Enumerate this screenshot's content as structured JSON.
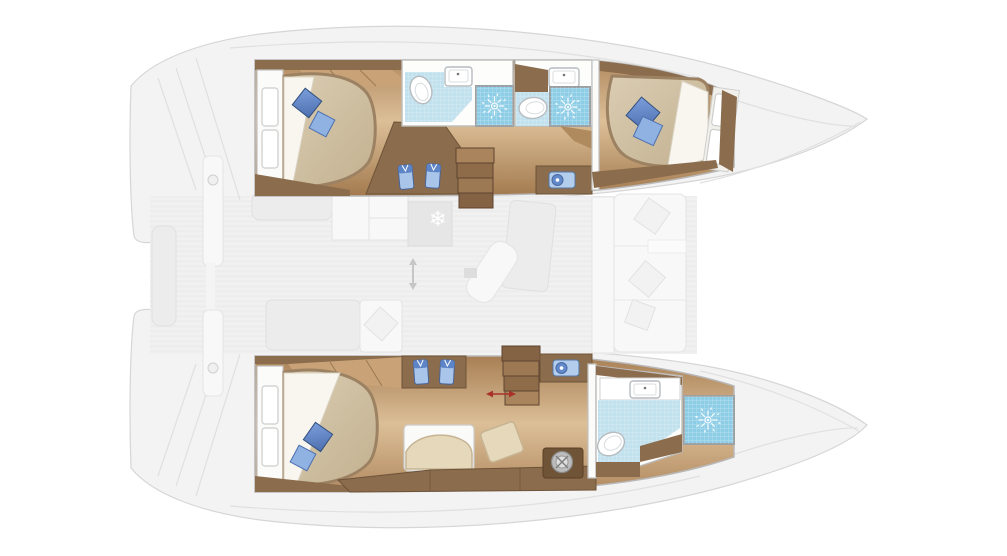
{
  "meta": {
    "title": "Catamaran interior layout — top-down floor plan",
    "view": "overhead deck plan, bows pointing right",
    "canvas": {
      "width": 1007,
      "height": 556
    }
  },
  "colors": {
    "wood_dark": "#8b6c4c",
    "wood_mid": "#b08a5f",
    "wood_wardrobe": "#c9a377",
    "floor_light": "#dcbf97",
    "mattress": "#d3c5a9",
    "mattress_rim": "#9c8262",
    "pillow_blue": "#6288c8",
    "tile_light": "#c2e1ee",
    "shower_blue": "#8ecde6",
    "faded_grey": "#f1f1f1",
    "accent_red": "#a8322a"
  },
  "hulls": {
    "port": {
      "position": "top hull",
      "rooms": [
        {
          "name": "aft double cabin",
          "features": [
            "double bed",
            "two blue pillows",
            "white headboard pillows",
            "wardrobe",
            "corner dresser with 2 blue folded towels"
          ]
        },
        {
          "name": "aft bathroom",
          "features": [
            "toilet",
            "washbasin",
            "shower cubicle with shower-head symbol"
          ]
        },
        {
          "name": "forward bathroom",
          "features": [
            "toilet",
            "washbasin",
            "shower cubicle with shower-head symbol"
          ]
        },
        {
          "name": "forward double cabin",
          "features": [
            "double bed",
            "blue pillow pair",
            "white headboard pillows",
            "vanity with small basin"
          ]
        }
      ],
      "stairs_steps": 4
    },
    "starboard": {
      "position": "bottom hull",
      "rooms": [
        {
          "name": "aft double cabin",
          "features": [
            "double bed",
            "two blue pillows",
            "white headboard pillows",
            "wardrobe"
          ]
        },
        {
          "name": "passageway",
          "features": [
            "dresser with 2 blue folded towels",
            "vanity with small basin",
            "lounge seat",
            "ottoman cushion",
            "cabinet run with winch-style pedestal"
          ]
        },
        {
          "name": "forward bathroom",
          "features": [
            "toilet",
            "washbasin",
            "shower cubicle with shower-head symbol"
          ]
        }
      ],
      "stairs_steps": 4
    }
  },
  "saloon": {
    "style": "faded grey (upper deck de-emphasized)",
    "items": [
      "galley counter",
      "cabinet block",
      "fridge unit with snowflake symbol",
      "dining table",
      "chaise lounge",
      "daybed with cushion",
      "forward cockpit sofa with three cushions",
      "aft cockpit bench",
      "transom steps",
      "davit posts"
    ]
  },
  "icons": {
    "shower_head": "white sunburst symbol on blue shower floor (x3)",
    "snowflake": "❄",
    "winch": "round metal pedestal",
    "red_arrow": "double-headed clearance arrow at starboard companionway",
    "grey_arrow": "double-headed vertical arrow in galley passage"
  }
}
